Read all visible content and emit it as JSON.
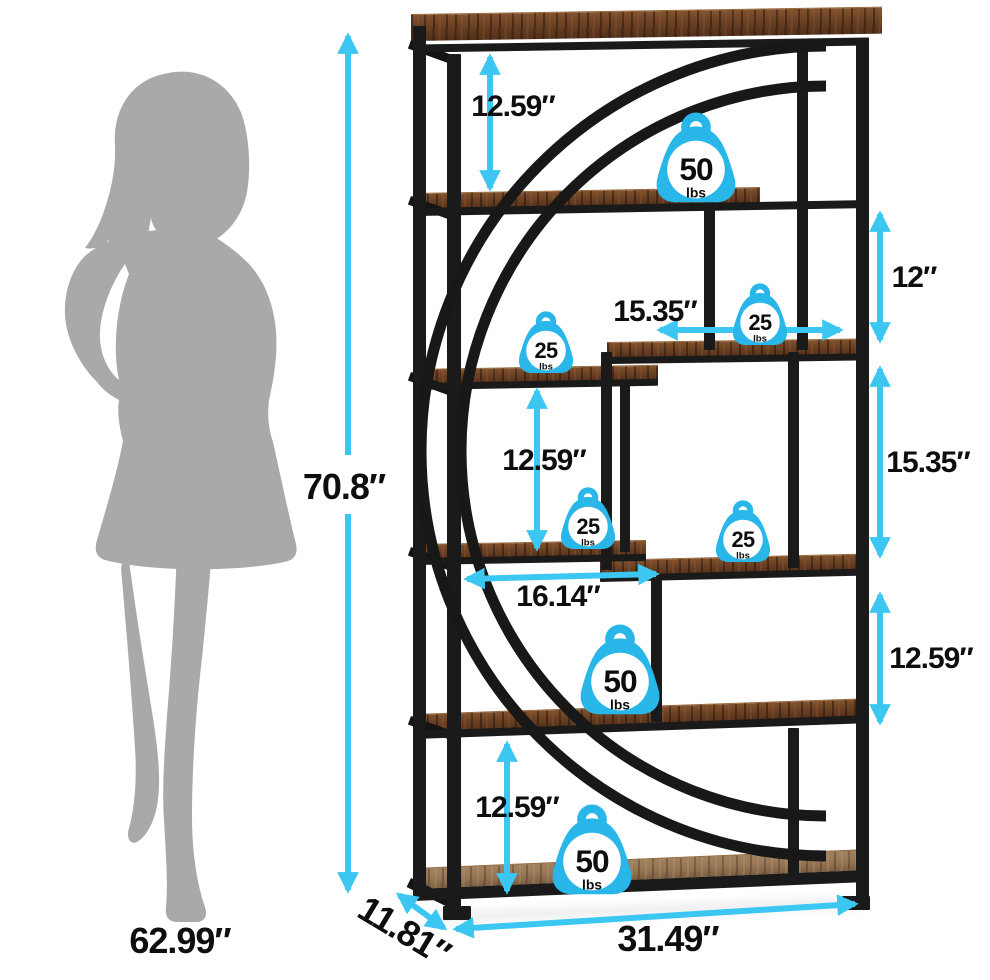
{
  "figure": {
    "type": "product dimension diagram",
    "subject": "industrial etagere bookshelf with half-moon arc frame",
    "scale_reference": "woman-silhouette",
    "capacity_icon": "weight-icon"
  },
  "colors": {
    "arrow_cyan": "#3cc6f2",
    "badge_cyan": "#29b7ea",
    "metal_black": "#1a1a1a",
    "wood_brown": "#6b4226",
    "silhouette_gray": "#a9a9a9",
    "label_black": "#0e0e0e",
    "background": "#ffffff"
  },
  "dims": {
    "overall_height": "70.8″",
    "person_height": "62.99″",
    "overall_width": "31.49″",
    "overall_depth": "11.81″",
    "top_shelf_gap": "12.59″",
    "right_top_gap": "12″",
    "right_shelf_width": "15.35″",
    "right_mid_gap": "15.35″",
    "left_mid_gap": "12.59″",
    "mid_shelf_width": "16.14″",
    "right_lower_gap": "12.59″",
    "bottom_shelf_gap": "12.59″"
  },
  "weights": [
    {
      "location": "top shelf",
      "value": "50",
      "unit": "lbs"
    },
    {
      "location": "upper right shelf",
      "value": "25",
      "unit": "lbs"
    },
    {
      "location": "upper left shelf",
      "value": "25",
      "unit": "lbs"
    },
    {
      "location": "middle left shelf",
      "value": "25",
      "unit": "lbs"
    },
    {
      "location": "middle right shelf",
      "value": "25",
      "unit": "lbs"
    },
    {
      "location": "lower shelf",
      "value": "50",
      "unit": "lbs"
    },
    {
      "location": "bottom shelf",
      "value": "50",
      "unit": "lbs"
    }
  ]
}
